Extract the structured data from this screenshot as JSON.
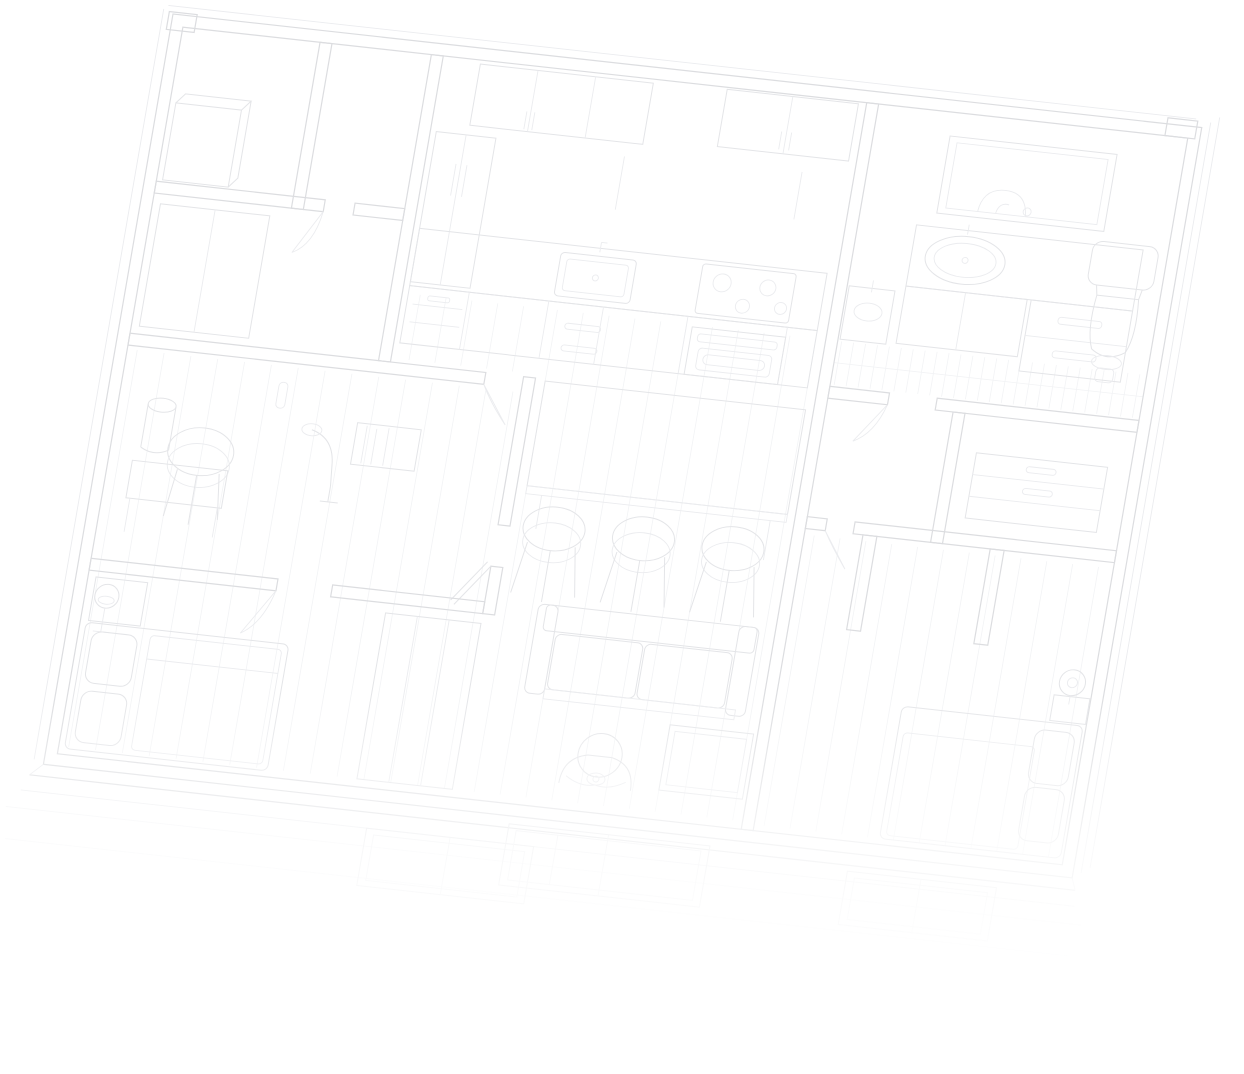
{
  "scene": {
    "label": "Very faint monochrome architectural line drawing: tilted top-down axonometric cutaway of an apartment interior, fading to white at the bottom",
    "elements": [
      {
        "id": "outer-walls",
        "label": "Apartment outer walls with thick double-line boundary"
      },
      {
        "id": "interior-walls",
        "label": "Interior partition walls with door openings and door leaves"
      },
      {
        "id": "floor-planks",
        "label": "Faint wood plank floor lines and bathroom floor tiles"
      },
      {
        "id": "kitchen",
        "label": "Kitchen: upper cabinets, tall cabinet, counter with sink, cooktop and oven"
      },
      {
        "id": "bathroom",
        "label": "Bathroom: wall mirror, vanity with oval sink, small basin and toilet"
      },
      {
        "id": "dining-set",
        "label": "Dining table with three round stools"
      },
      {
        "id": "living-area",
        "label": "Living area: sofa with cushions, side table, seated person holding a cup"
      },
      {
        "id": "study",
        "label": "Study corner: desk, round stool, bin, shelf and arc floor lamp"
      },
      {
        "id": "bedroom-left",
        "label": "Left bedroom: bed with pillows, floor lamp and wardrobe"
      },
      {
        "id": "bedroom-right",
        "label": "Right bedroom: bed with pillows, nightstand lamp, dresser and closet stubs"
      },
      {
        "id": "facade-windows",
        "label": "Front facade wall band with window frames, fading out"
      },
      {
        "id": "fade-overlay",
        "label": "White fade-out gradient over the lower part of the drawing"
      }
    ]
  },
  "palette": {
    "background": "#ffffff",
    "wall_line": "#dcdde0",
    "furniture_line": "#e4e5e8",
    "detail_line": "#ebecef",
    "floor_line": "#f2f3f5"
  }
}
